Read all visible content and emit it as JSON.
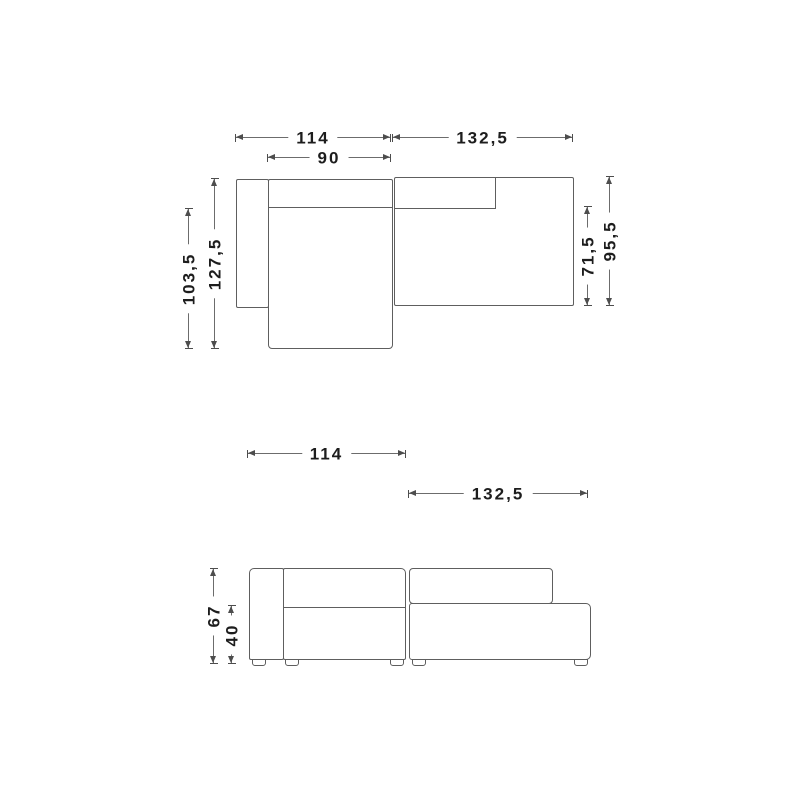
{
  "diagram": {
    "top_view": {
      "width_left": "114",
      "width_right": "132,5",
      "seat_width": "90",
      "depth_inner_left": "103,5",
      "depth_total_left": "127,5",
      "depth_inner_right": "71,5",
      "depth_total_right": "95,5"
    },
    "front_view": {
      "width_left": "114",
      "width_right": "132,5",
      "height_total": "67",
      "height_seat": "40"
    }
  }
}
